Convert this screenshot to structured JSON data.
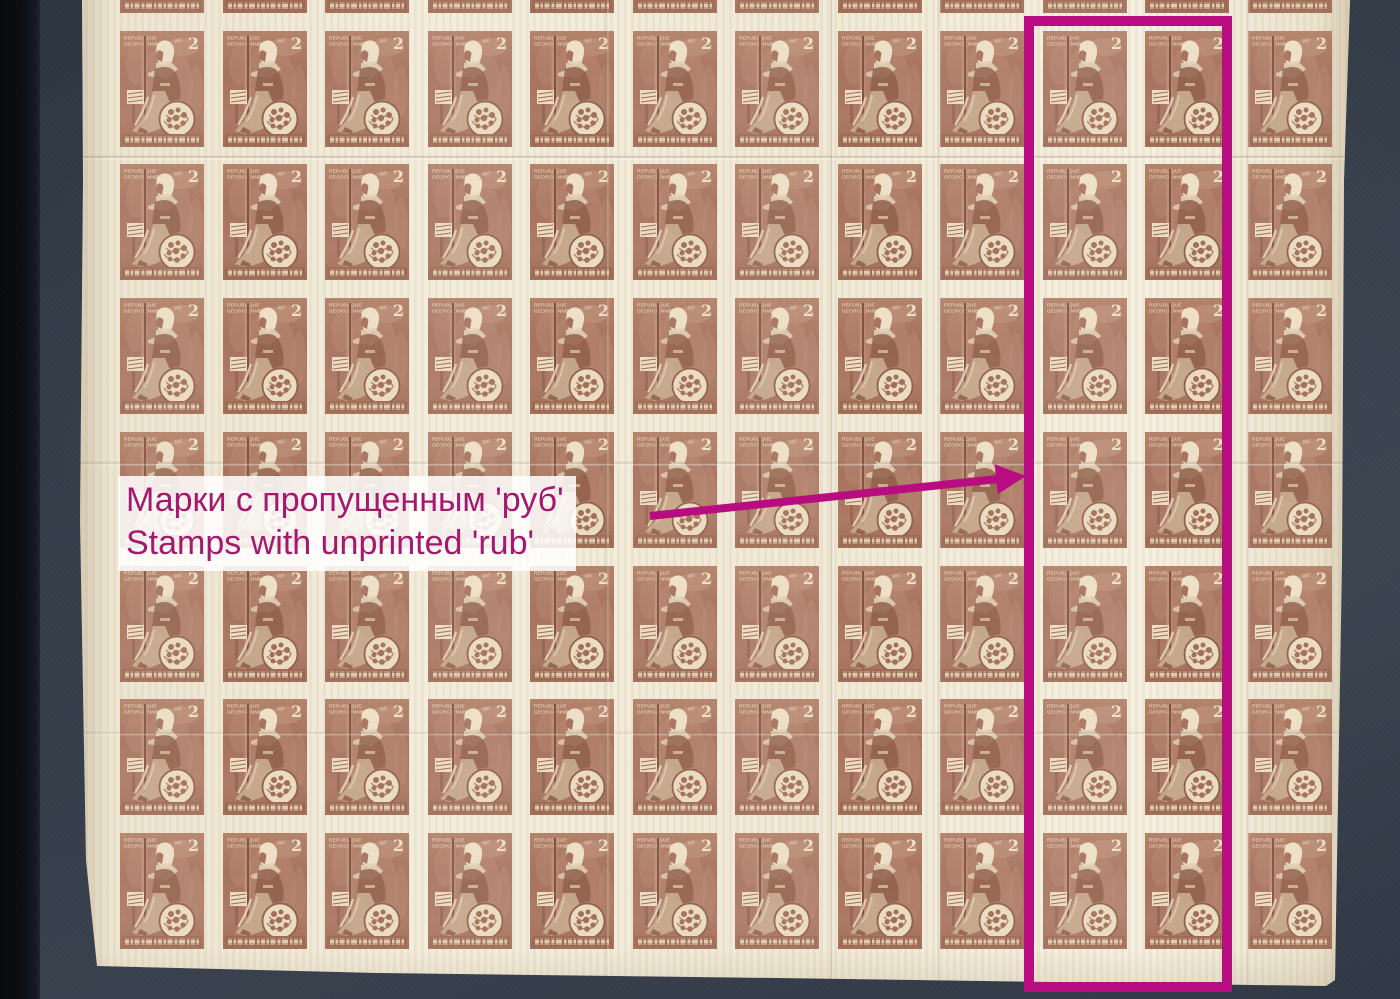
{
  "scene": {
    "background_color": "#353d4a",
    "left_bar_color": "#0b0d11",
    "sheet_paper_color": "#f0e8d5"
  },
  "stamp": {
    "country_line1": "REPUBLIQUE",
    "country_line2": "GEORGIENNE",
    "denomination": "2",
    "rub_label": "руб",
    "ink_color": "#a5705c",
    "paper_color": "#ecdfc9",
    "grid": {
      "columns": 12,
      "rows": 8,
      "first_column_x": 120,
      "first_row_y": -103,
      "column_pitch": 102.5,
      "row_pitch": 133.7,
      "stamp_width": 84,
      "stamp_height": 116,
      "highlight_columns": [
        9,
        10
      ]
    }
  },
  "annotation": {
    "highlight_color": "#b70d80",
    "label_text_color": "#a4186e",
    "label_line1_ru": "Марки с пропущенным 'руб'",
    "label_line2_en": "Stamps with unprinted 'rub'",
    "rect": {
      "x": 1024,
      "y": 16,
      "width": 208,
      "height": 976,
      "stroke": 10
    },
    "arrow": {
      "x1": 650,
      "y1": 516,
      "tip_x": 1026,
      "tip_y": 476,
      "stroke": 8,
      "head_length": 30,
      "head_width": 30
    }
  }
}
